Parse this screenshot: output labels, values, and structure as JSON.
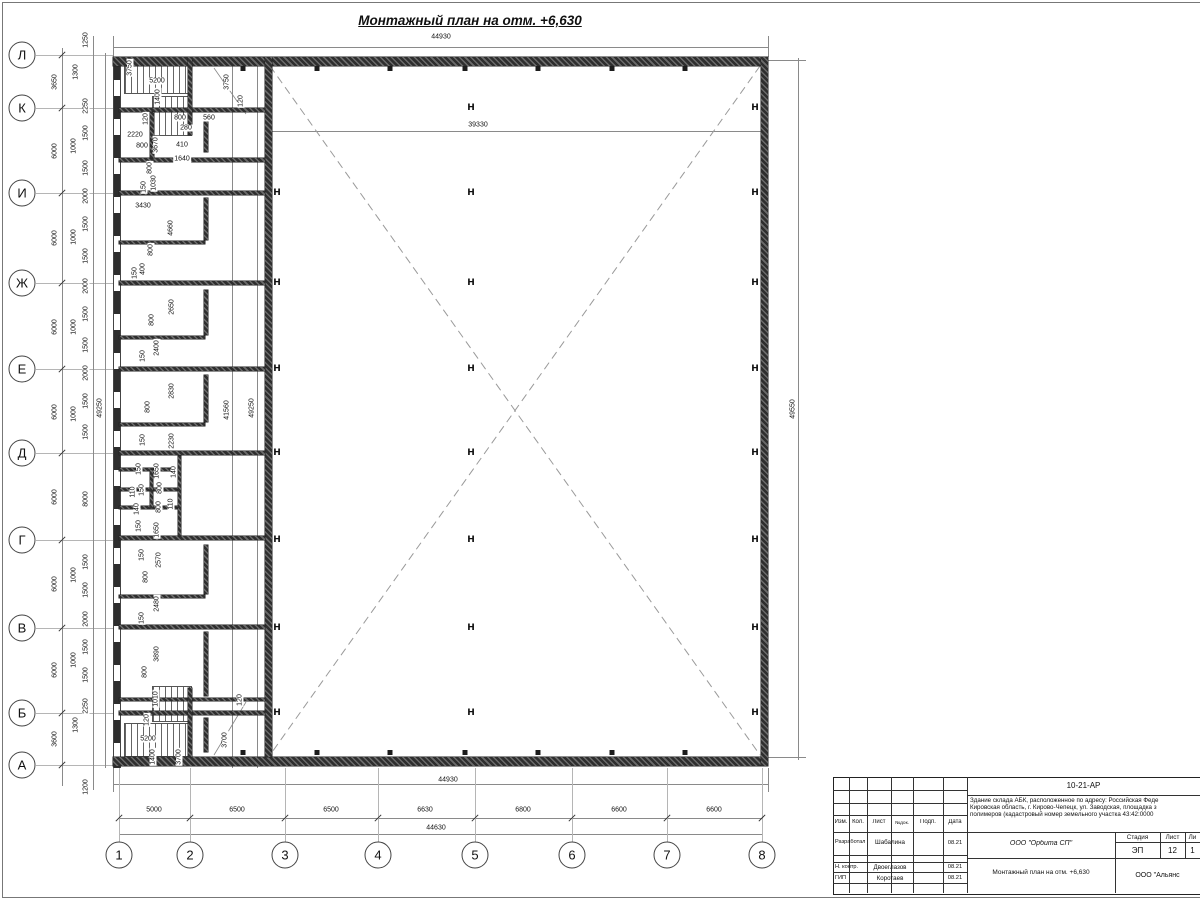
{
  "sheet": {
    "main_title": "Монтажный план на отм. +6,630"
  },
  "plan": {
    "axis_rows": [
      {
        "label": "Л",
        "y": 55
      },
      {
        "label": "К",
        "y": 108
      },
      {
        "label": "И",
        "y": 193
      },
      {
        "label": "Ж",
        "y": 283
      },
      {
        "label": "Е",
        "y": 369
      },
      {
        "label": "Д",
        "y": 453
      },
      {
        "label": "Г",
        "y": 540
      },
      {
        "label": "В",
        "y": 628
      },
      {
        "label": "Б",
        "y": 713
      },
      {
        "label": "А",
        "y": 765
      }
    ],
    "axis_cols": [
      {
        "label": "1",
        "x": 119
      },
      {
        "label": "2",
        "x": 190
      },
      {
        "label": "3",
        "x": 285
      },
      {
        "label": "4",
        "x": 378
      },
      {
        "label": "5",
        "x": 475
      },
      {
        "label": "6",
        "x": 572
      },
      {
        "label": "7",
        "x": 667
      },
      {
        "label": "8",
        "x": 762
      }
    ],
    "steel_column_glyph": "H",
    "steel_column_lines": [
      {
        "x": 471,
        "rows": [
          108,
          193,
          283,
          369,
          453,
          540,
          628,
          713
        ]
      },
      {
        "x": 755,
        "rows": [
          108,
          193,
          283,
          369,
          453,
          540,
          628,
          713
        ]
      },
      {
        "x": 277,
        "rows": [
          193,
          283,
          369,
          453,
          540,
          628,
          713
        ]
      }
    ],
    "dim_labels": [
      {
        "t": "44930",
        "x": 441,
        "y": 37
      },
      {
        "t": "39330",
        "x": 478,
        "y": 125
      },
      {
        "t": "1250",
        "x": 86,
        "y": 40,
        "r": 1
      },
      {
        "t": "3650",
        "x": 55,
        "y": 82,
        "r": 1
      },
      {
        "t": "1300",
        "x": 76,
        "y": 72,
        "r": 1
      },
      {
        "t": "2250",
        "x": 86,
        "y": 106,
        "r": 1
      },
      {
        "t": "6000",
        "x": 55,
        "y": 151,
        "r": 1
      },
      {
        "t": "1500",
        "x": 86,
        "y": 133,
        "r": 1
      },
      {
        "t": "1000",
        "x": 74,
        "y": 146,
        "r": 1
      },
      {
        "t": "1500",
        "x": 86,
        "y": 168,
        "r": 1
      },
      {
        "t": "2000",
        "x": 86,
        "y": 196,
        "r": 1
      },
      {
        "t": "6000",
        "x": 55,
        "y": 238,
        "r": 1
      },
      {
        "t": "1500",
        "x": 86,
        "y": 224,
        "r": 1
      },
      {
        "t": "1000",
        "x": 74,
        "y": 237,
        "r": 1
      },
      {
        "t": "1500",
        "x": 86,
        "y": 256,
        "r": 1
      },
      {
        "t": "2000",
        "x": 86,
        "y": 286,
        "r": 1
      },
      {
        "t": "6000",
        "x": 55,
        "y": 327,
        "r": 1
      },
      {
        "t": "1500",
        "x": 86,
        "y": 314,
        "r": 1
      },
      {
        "t": "1000",
        "x": 74,
        "y": 327,
        "r": 1
      },
      {
        "t": "1500",
        "x": 86,
        "y": 345,
        "r": 1
      },
      {
        "t": "2000",
        "x": 86,
        "y": 373,
        "r": 1
      },
      {
        "t": "6000",
        "x": 55,
        "y": 412,
        "r": 1
      },
      {
        "t": "1500",
        "x": 86,
        "y": 401,
        "r": 1
      },
      {
        "t": "1000",
        "x": 74,
        "y": 414,
        "r": 1
      },
      {
        "t": "1500",
        "x": 86,
        "y": 432,
        "r": 1
      },
      {
        "t": "6000",
        "x": 55,
        "y": 497,
        "r": 1
      },
      {
        "t": "8000",
        "x": 86,
        "y": 499,
        "r": 1
      },
      {
        "t": "6000",
        "x": 55,
        "y": 584,
        "r": 1
      },
      {
        "t": "1500",
        "x": 86,
        "y": 562,
        "r": 1
      },
      {
        "t": "1000",
        "x": 74,
        "y": 575,
        "r": 1
      },
      {
        "t": "1500",
        "x": 86,
        "y": 590,
        "r": 1
      },
      {
        "t": "2000",
        "x": 86,
        "y": 619,
        "r": 1
      },
      {
        "t": "6000",
        "x": 55,
        "y": 670,
        "r": 1
      },
      {
        "t": "1500",
        "x": 86,
        "y": 647,
        "r": 1
      },
      {
        "t": "1000",
        "x": 74,
        "y": 660,
        "r": 1
      },
      {
        "t": "1500",
        "x": 86,
        "y": 675,
        "r": 1
      },
      {
        "t": "2250",
        "x": 86,
        "y": 706,
        "r": 1
      },
      {
        "t": "1300",
        "x": 76,
        "y": 725,
        "r": 1
      },
      {
        "t": "3600",
        "x": 55,
        "y": 739,
        "r": 1
      },
      {
        "t": "1200",
        "x": 86,
        "y": 787,
        "r": 1
      },
      {
        "t": "49250",
        "x": 100,
        "y": 408,
        "r": 1
      },
      {
        "t": "3750",
        "x": 130,
        "y": 68,
        "r": 1
      },
      {
        "t": "5200",
        "x": 157,
        "y": 81
      },
      {
        "t": "1400",
        "x": 158,
        "y": 97,
        "r": 1
      },
      {
        "t": "120",
        "x": 146,
        "y": 119,
        "r": 1
      },
      {
        "t": "800",
        "x": 180,
        "y": 118
      },
      {
        "t": "560",
        "x": 209,
        "y": 118
      },
      {
        "t": "280",
        "x": 186,
        "y": 128
      },
      {
        "t": "2220",
        "x": 135,
        "y": 135
      },
      {
        "t": "800",
        "x": 142,
        "y": 146
      },
      {
        "t": "3670",
        "x": 156,
        "y": 145,
        "r": 1
      },
      {
        "t": "410",
        "x": 182,
        "y": 145
      },
      {
        "t": "1640",
        "x": 182,
        "y": 159
      },
      {
        "t": "800",
        "x": 150,
        "y": 168,
        "r": 1
      },
      {
        "t": "3750",
        "x": 227,
        "y": 82,
        "r": 1
      },
      {
        "t": "120",
        "x": 241,
        "y": 101,
        "r": 1
      },
      {
        "t": "150",
        "x": 144,
        "y": 187,
        "r": 1
      },
      {
        "t": "1030",
        "x": 154,
        "y": 183,
        "r": 1
      },
      {
        "t": "3430",
        "x": 143,
        "y": 206
      },
      {
        "t": "4660",
        "x": 171,
        "y": 228,
        "r": 1
      },
      {
        "t": "800",
        "x": 151,
        "y": 250,
        "r": 1
      },
      {
        "t": "400",
        "x": 143,
        "y": 269,
        "r": 1
      },
      {
        "t": "150",
        "x": 135,
        "y": 273,
        "r": 1
      },
      {
        "t": "2650",
        "x": 172,
        "y": 307,
        "r": 1
      },
      {
        "t": "800",
        "x": 152,
        "y": 320,
        "r": 1
      },
      {
        "t": "2400",
        "x": 157,
        "y": 348,
        "r": 1
      },
      {
        "t": "150",
        "x": 143,
        "y": 356,
        "r": 1
      },
      {
        "t": "2830",
        "x": 172,
        "y": 391,
        "r": 1
      },
      {
        "t": "800",
        "x": 148,
        "y": 407,
        "r": 1
      },
      {
        "t": "150",
        "x": 143,
        "y": 440,
        "r": 1
      },
      {
        "t": "2230",
        "x": 172,
        "y": 441,
        "r": 1
      },
      {
        "t": "150",
        "x": 139,
        "y": 469,
        "r": 1
      },
      {
        "t": "1650",
        "x": 157,
        "y": 471,
        "r": 1
      },
      {
        "t": "140",
        "x": 174,
        "y": 472,
        "r": 1
      },
      {
        "t": "110",
        "x": 133,
        "y": 492,
        "r": 1
      },
      {
        "t": "150",
        "x": 142,
        "y": 490,
        "r": 1
      },
      {
        "t": "800",
        "x": 160,
        "y": 488,
        "r": 1
      },
      {
        "t": "140",
        "x": 137,
        "y": 509,
        "r": 1
      },
      {
        "t": "800",
        "x": 159,
        "y": 507,
        "r": 1
      },
      {
        "t": "110",
        "x": 171,
        "y": 504,
        "r": 1
      },
      {
        "t": "150",
        "x": 139,
        "y": 526,
        "r": 1
      },
      {
        "t": "1650",
        "x": 157,
        "y": 530,
        "r": 1
      },
      {
        "t": "150",
        "x": 142,
        "y": 555,
        "r": 1
      },
      {
        "t": "2570",
        "x": 159,
        "y": 560,
        "r": 1
      },
      {
        "t": "800",
        "x": 146,
        "y": 577,
        "r": 1
      },
      {
        "t": "2480",
        "x": 157,
        "y": 604,
        "r": 1
      },
      {
        "t": "150",
        "x": 142,
        "y": 618,
        "r": 1
      },
      {
        "t": "3890",
        "x": 157,
        "y": 654,
        "r": 1
      },
      {
        "t": "800",
        "x": 145,
        "y": 672,
        "r": 1
      },
      {
        "t": "1010",
        "x": 156,
        "y": 699,
        "r": 1
      },
      {
        "t": "120",
        "x": 147,
        "y": 720,
        "r": 1
      },
      {
        "t": "5200",
        "x": 148,
        "y": 739
      },
      {
        "t": "1400",
        "x": 153,
        "y": 757,
        "r": 1
      },
      {
        "t": "3700",
        "x": 179,
        "y": 757,
        "r": 1
      },
      {
        "t": "3700",
        "x": 225,
        "y": 740,
        "r": 1
      },
      {
        "t": "120",
        "x": 240,
        "y": 700,
        "r": 1
      },
      {
        "t": "41560",
        "x": 227,
        "y": 410,
        "r": 1
      },
      {
        "t": "49250",
        "x": 252,
        "y": 408,
        "r": 1
      },
      {
        "t": "49550",
        "x": 793,
        "y": 409,
        "r": 1
      },
      {
        "t": "44930",
        "x": 448,
        "y": 780
      },
      {
        "t": "44630",
        "x": 436,
        "y": 828
      },
      {
        "t": "5000",
        "x": 154,
        "y": 810
      },
      {
        "t": "6500",
        "x": 237,
        "y": 810
      },
      {
        "t": "6500",
        "x": 331,
        "y": 810
      },
      {
        "t": "6630",
        "x": 425,
        "y": 810
      },
      {
        "t": "6800",
        "x": 523,
        "y": 810
      },
      {
        "t": "6600",
        "x": 619,
        "y": 810
      },
      {
        "t": "6600",
        "x": 714,
        "y": 810
      }
    ]
  },
  "title_block": {
    "code": "10-21-АР",
    "description": "Здание склада АБК, расположенное по адресу: Российская Феде\nКировская область, г. Кирово-Чепецк, ул. Заводская, площадка з\nполимеров (кадастровый номер земельного участка 43:42:0000",
    "headers": {
      "izm": "Изм.",
      "kol": "Кол.",
      "list": "Лист",
      "ndok": "№док.",
      "podp": "Подп.",
      "data": "Дата"
    },
    "roles": [
      {
        "role": "Разработал",
        "name": "Шабалина",
        "date": "08.21"
      },
      {
        "role": "Н. контр.",
        "name": "Двоеглазов",
        "date": "08.21"
      },
      {
        "role": "ГИП",
        "name": "Коротаев",
        "date": "08.21"
      }
    ],
    "org": "ООО \"Орбита СП\"",
    "doc_title": "Монтажный план на отм. +6,630",
    "stage_header": {
      "stage": "Стадия",
      "sheet": "Лист",
      "sheets": "Ли"
    },
    "stage_values": {
      "stage": "ЭП",
      "sheet": "12",
      "sheets": "1"
    },
    "company": "ООО \"Альянс"
  }
}
